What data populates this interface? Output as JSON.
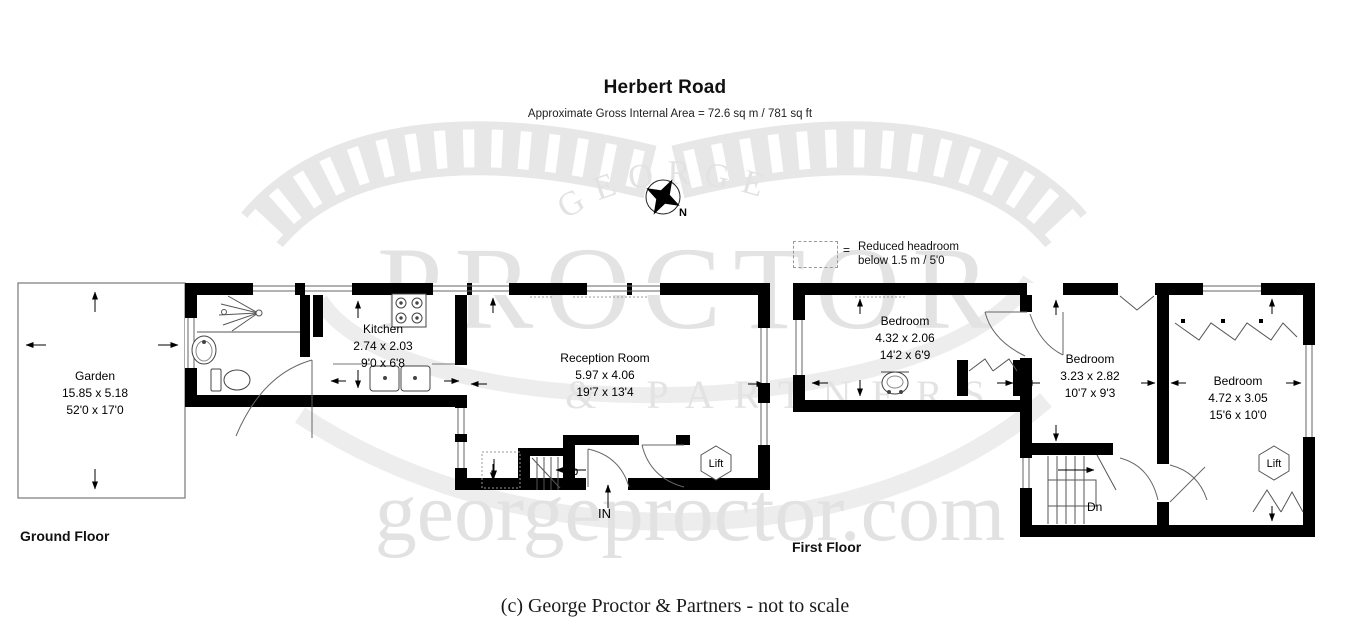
{
  "header": {
    "title": "Herbert Road",
    "subtitle": "Approximate Gross Internal Area = 72.6 sq m / 781 sq ft"
  },
  "compass": {
    "north_label": "N"
  },
  "legend": {
    "equals": "=",
    "line1": "Reduced headroom",
    "line2": "below 1.5 m / 5'0"
  },
  "watermark": {
    "top": "GEORGE",
    "middle": "PROCTOR",
    "partners": "& PARTNERS",
    "url": "georgeproctor.com",
    "color": "#e4e4e4"
  },
  "ground_floor": {
    "label": "Ground Floor",
    "garden": {
      "name": "Garden",
      "metric": "15.85 x 5.18",
      "imperial": "52'0 x 17'0"
    },
    "kitchen": {
      "name": "Kitchen",
      "metric": "2.74 x 2.03",
      "imperial": "9'0 x 6'8"
    },
    "reception": {
      "name": "Reception Room",
      "metric": "5.97 x 4.06",
      "imperial": "19'7 x 13'4"
    },
    "stairs_label": "Up",
    "entrance_label": "IN",
    "lift_label": "Lift"
  },
  "first_floor": {
    "label": "First Floor",
    "bedroom1": {
      "name": "Bedroom",
      "metric": "4.32 x 2.06",
      "imperial": "14'2 x 6'9"
    },
    "bedroom2": {
      "name": "Bedroom",
      "metric": "3.23 x 2.82",
      "imperial": "10'7 x 9'3"
    },
    "bedroom3": {
      "name": "Bedroom",
      "metric": "4.72 x 3.05",
      "imperial": "15'6 x 10'0"
    },
    "stairs_label": "Dn",
    "lift_label": "Lift"
  },
  "footer": {
    "copyright": "(c) George Proctor & Partners - not to scale"
  },
  "colors": {
    "wall": "#000000",
    "thin_line": "#444444",
    "watermark": "#e4e4e4"
  }
}
